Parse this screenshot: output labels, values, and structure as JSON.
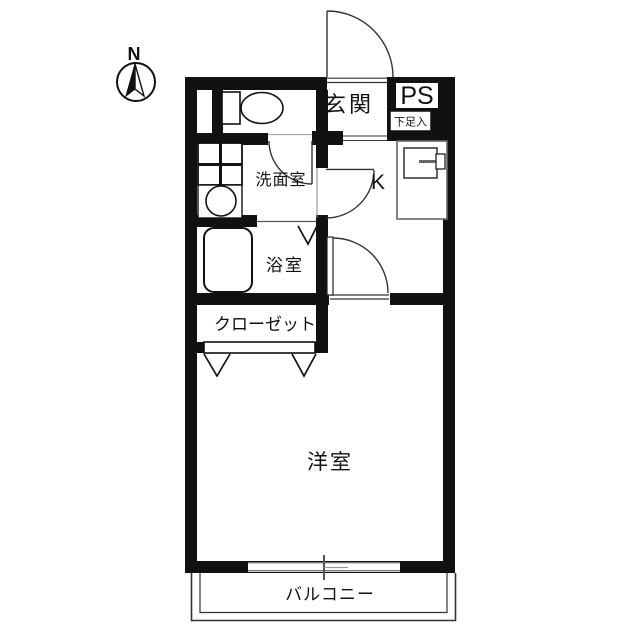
{
  "title": "apartment-floor-plan",
  "compass": {
    "label": "N"
  },
  "rooms": {
    "entrance": {
      "label": "玄関"
    },
    "pipe_space": {
      "label": "PS"
    },
    "shoe_box": {
      "label": "下足入"
    },
    "kitchen": {
      "label": "K"
    },
    "washroom": {
      "label": "洗面室"
    },
    "bathroom": {
      "label": "浴室"
    },
    "closet": {
      "label": "クローゼット"
    },
    "western_room": {
      "label": "洋室"
    },
    "balcony": {
      "label": "バルコニー"
    }
  },
  "fixtures": [
    "toilet",
    "washbasin",
    "washing-machine-space",
    "bathtub",
    "kitchen-sink",
    "entrance-door",
    "compass-north-arrow"
  ],
  "colors": {
    "wall": "#111111",
    "line": "#333333",
    "background": "#ffffff"
  }
}
